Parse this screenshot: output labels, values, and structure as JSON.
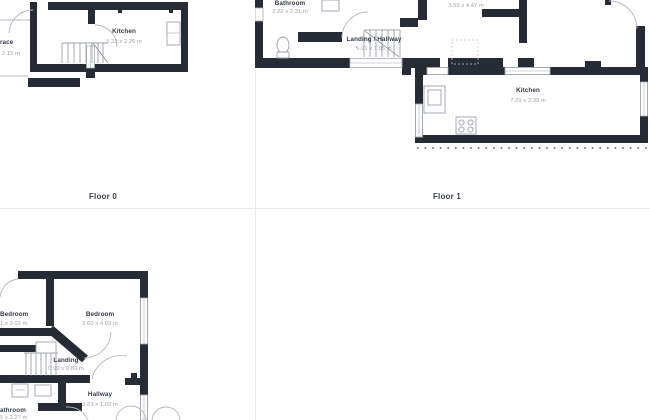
{
  "page": {
    "background": "#ffffff",
    "divider_color": "#ebebeb"
  },
  "colors": {
    "wall": "#262b36",
    "room_name_text": "#333945",
    "dimension_text": "#a0a5ad",
    "floor_label_text": "#3b4049",
    "door_arc": "#b4b8bf"
  },
  "floors": [
    {
      "label": "Floor 0",
      "rooms": [
        {
          "name": "Kitchen",
          "dims": "5.22 x 2.26 m"
        },
        {
          "name": "race",
          "dims": "2.15 m"
        }
      ]
    },
    {
      "label": "Floor 1",
      "rooms": [
        {
          "name": "Bathroom",
          "dims": "2.22 x 2.31 m"
        },
        {
          "name": "Landing / Hallway",
          "dims": "5.91 x 1.85 m"
        },
        {
          "name": "",
          "dims": "3.59 x 4.47 m"
        },
        {
          "name": "Kitchen",
          "dims": "7.29 x 2.39 m"
        }
      ]
    },
    {
      "rooms": [
        {
          "name": "Bedroom",
          "dims": "1 x 3.02 m"
        },
        {
          "name": "Bedroom",
          "dims": "3.60 x 4.03 m"
        },
        {
          "name": "Landing",
          "dims": "0.99 x 0.89 m"
        },
        {
          "name": "Hallway",
          "dims": "3.83 x 1.82 m"
        },
        {
          "name": "athroom",
          "dims": "5 x 2.27 m"
        }
      ]
    }
  ]
}
